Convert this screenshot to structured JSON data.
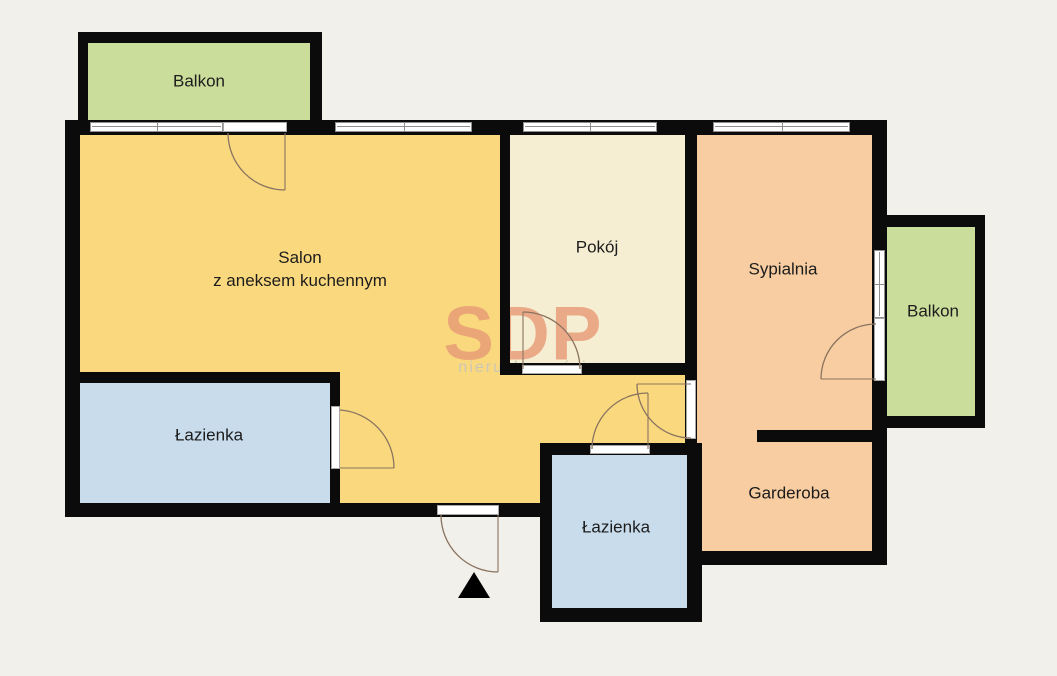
{
  "plan": {
    "title": "Apartment floor plan",
    "watermark": {
      "brand": "SDP",
      "subtitle": "nieruchomości",
      "brand_color": "#e89a76",
      "subtitle_color": "#c9c6ba"
    },
    "rooms": {
      "balkon_top": {
        "label": "Balkon",
        "color": "#cbdd9b"
      },
      "salon": {
        "label": "Salon",
        "sublabel": "z aneksem kuchennym",
        "color": "#fad97e"
      },
      "pokoj": {
        "label": "Pokój",
        "color": "#f5eed2"
      },
      "sypialnia": {
        "label": "Sypialnia",
        "color": "#f7cda1"
      },
      "balkon_right": {
        "label": "Balkon",
        "color": "#cbdd9b"
      },
      "lazienka_left": {
        "label": "Łazienka",
        "color": "#c8dcec"
      },
      "lazienka_mid": {
        "label": "Łazienka",
        "color": "#c8dcec"
      },
      "garderoba": {
        "label": "Garderoba",
        "color": "#f7cda1"
      }
    },
    "colors": {
      "background": "#f1f0ea",
      "wall": "#0b0b0b",
      "window_frame": "#8f8f8f",
      "door_arc": "#8a7360",
      "entrance_marker": "#000000"
    }
  }
}
